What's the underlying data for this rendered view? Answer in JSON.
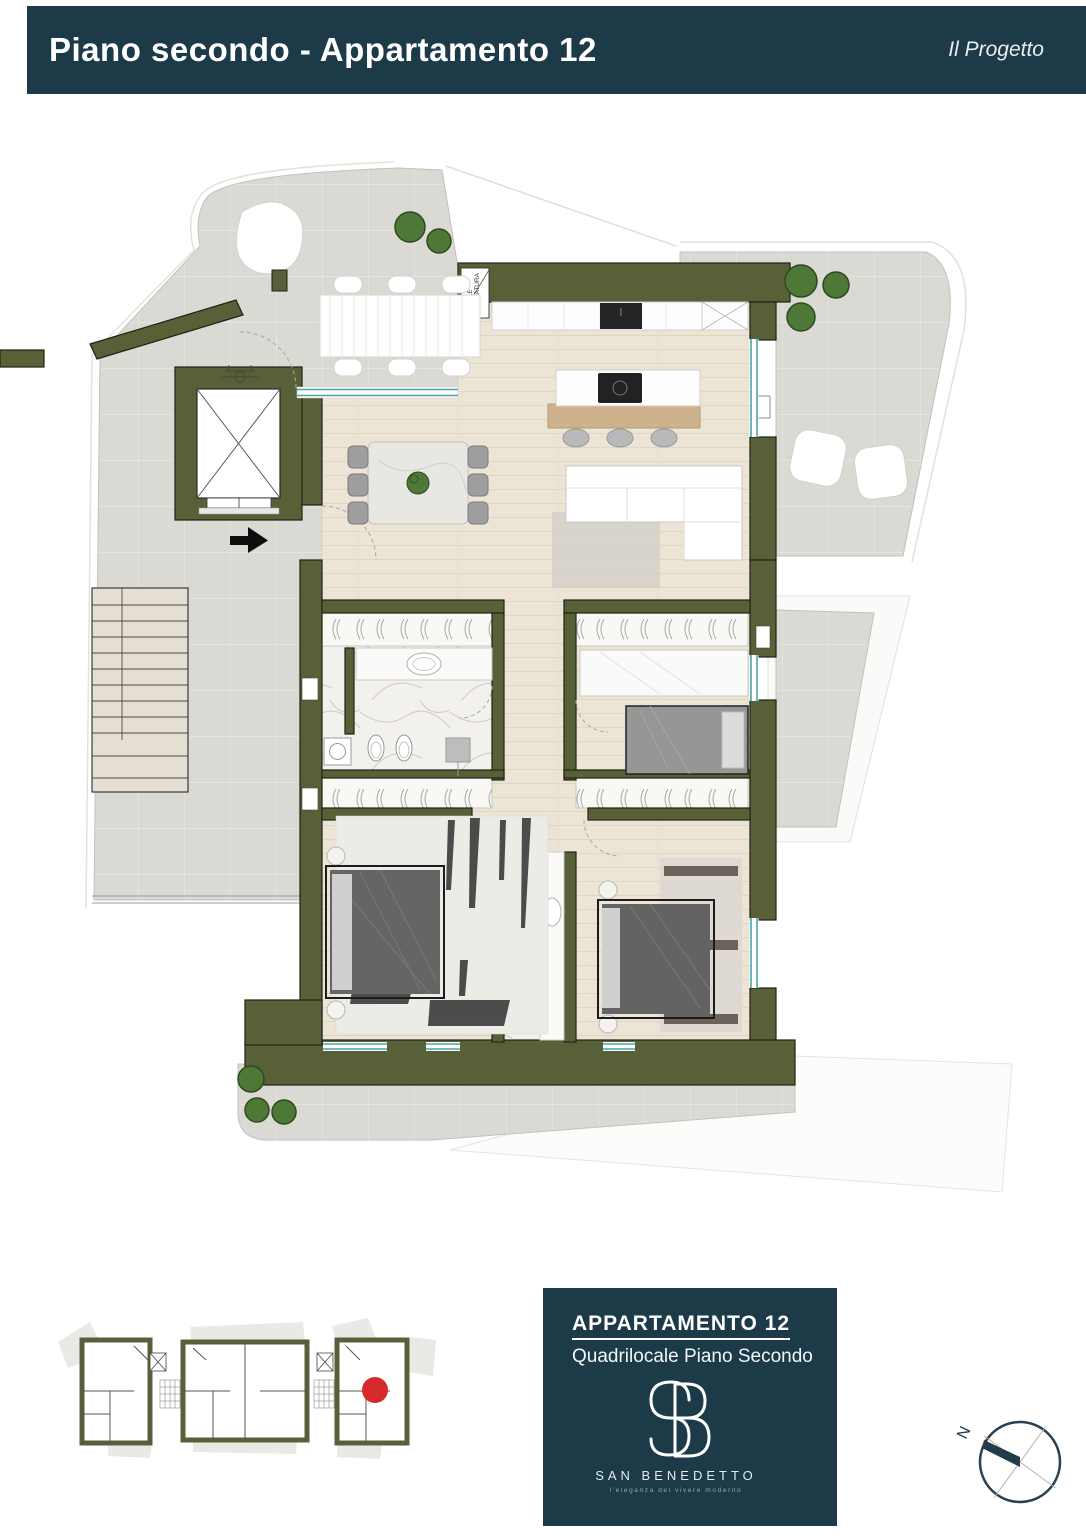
{
  "header": {
    "title": "Piano secondo - Appartamento 12",
    "right_label": "Il Progetto",
    "bg_color": "#1d3a48"
  },
  "plan": {
    "labels": {
      "waste_room": "LOCALE SPAZZATURA",
      "waste_room_lines": [
        "LOCALE",
        "SPAZZATURA"
      ]
    },
    "colors": {
      "wall_olive": "#586037",
      "window_teal": "#4aa4a9",
      "terrace_gray": "#dbd9d4",
      "wood_floor": "#ece4d5",
      "marble": "#f3f1ed",
      "tree_green": "#4d7836",
      "entry_arrow": "#0d0d0d"
    }
  },
  "keyplan": {
    "marker_color": "#d42a2e"
  },
  "footer": {
    "apartment_title": "APPARTAMENTO 12",
    "apartment_subtitle": "Quadrilocale Piano Secondo",
    "brand": "SAN BENEDETTO",
    "brand_tagline": "l'eleganza del vivere moderno",
    "monogram": "SB",
    "bg_color": "#1d3a48"
  },
  "compass": {
    "label": "N"
  }
}
